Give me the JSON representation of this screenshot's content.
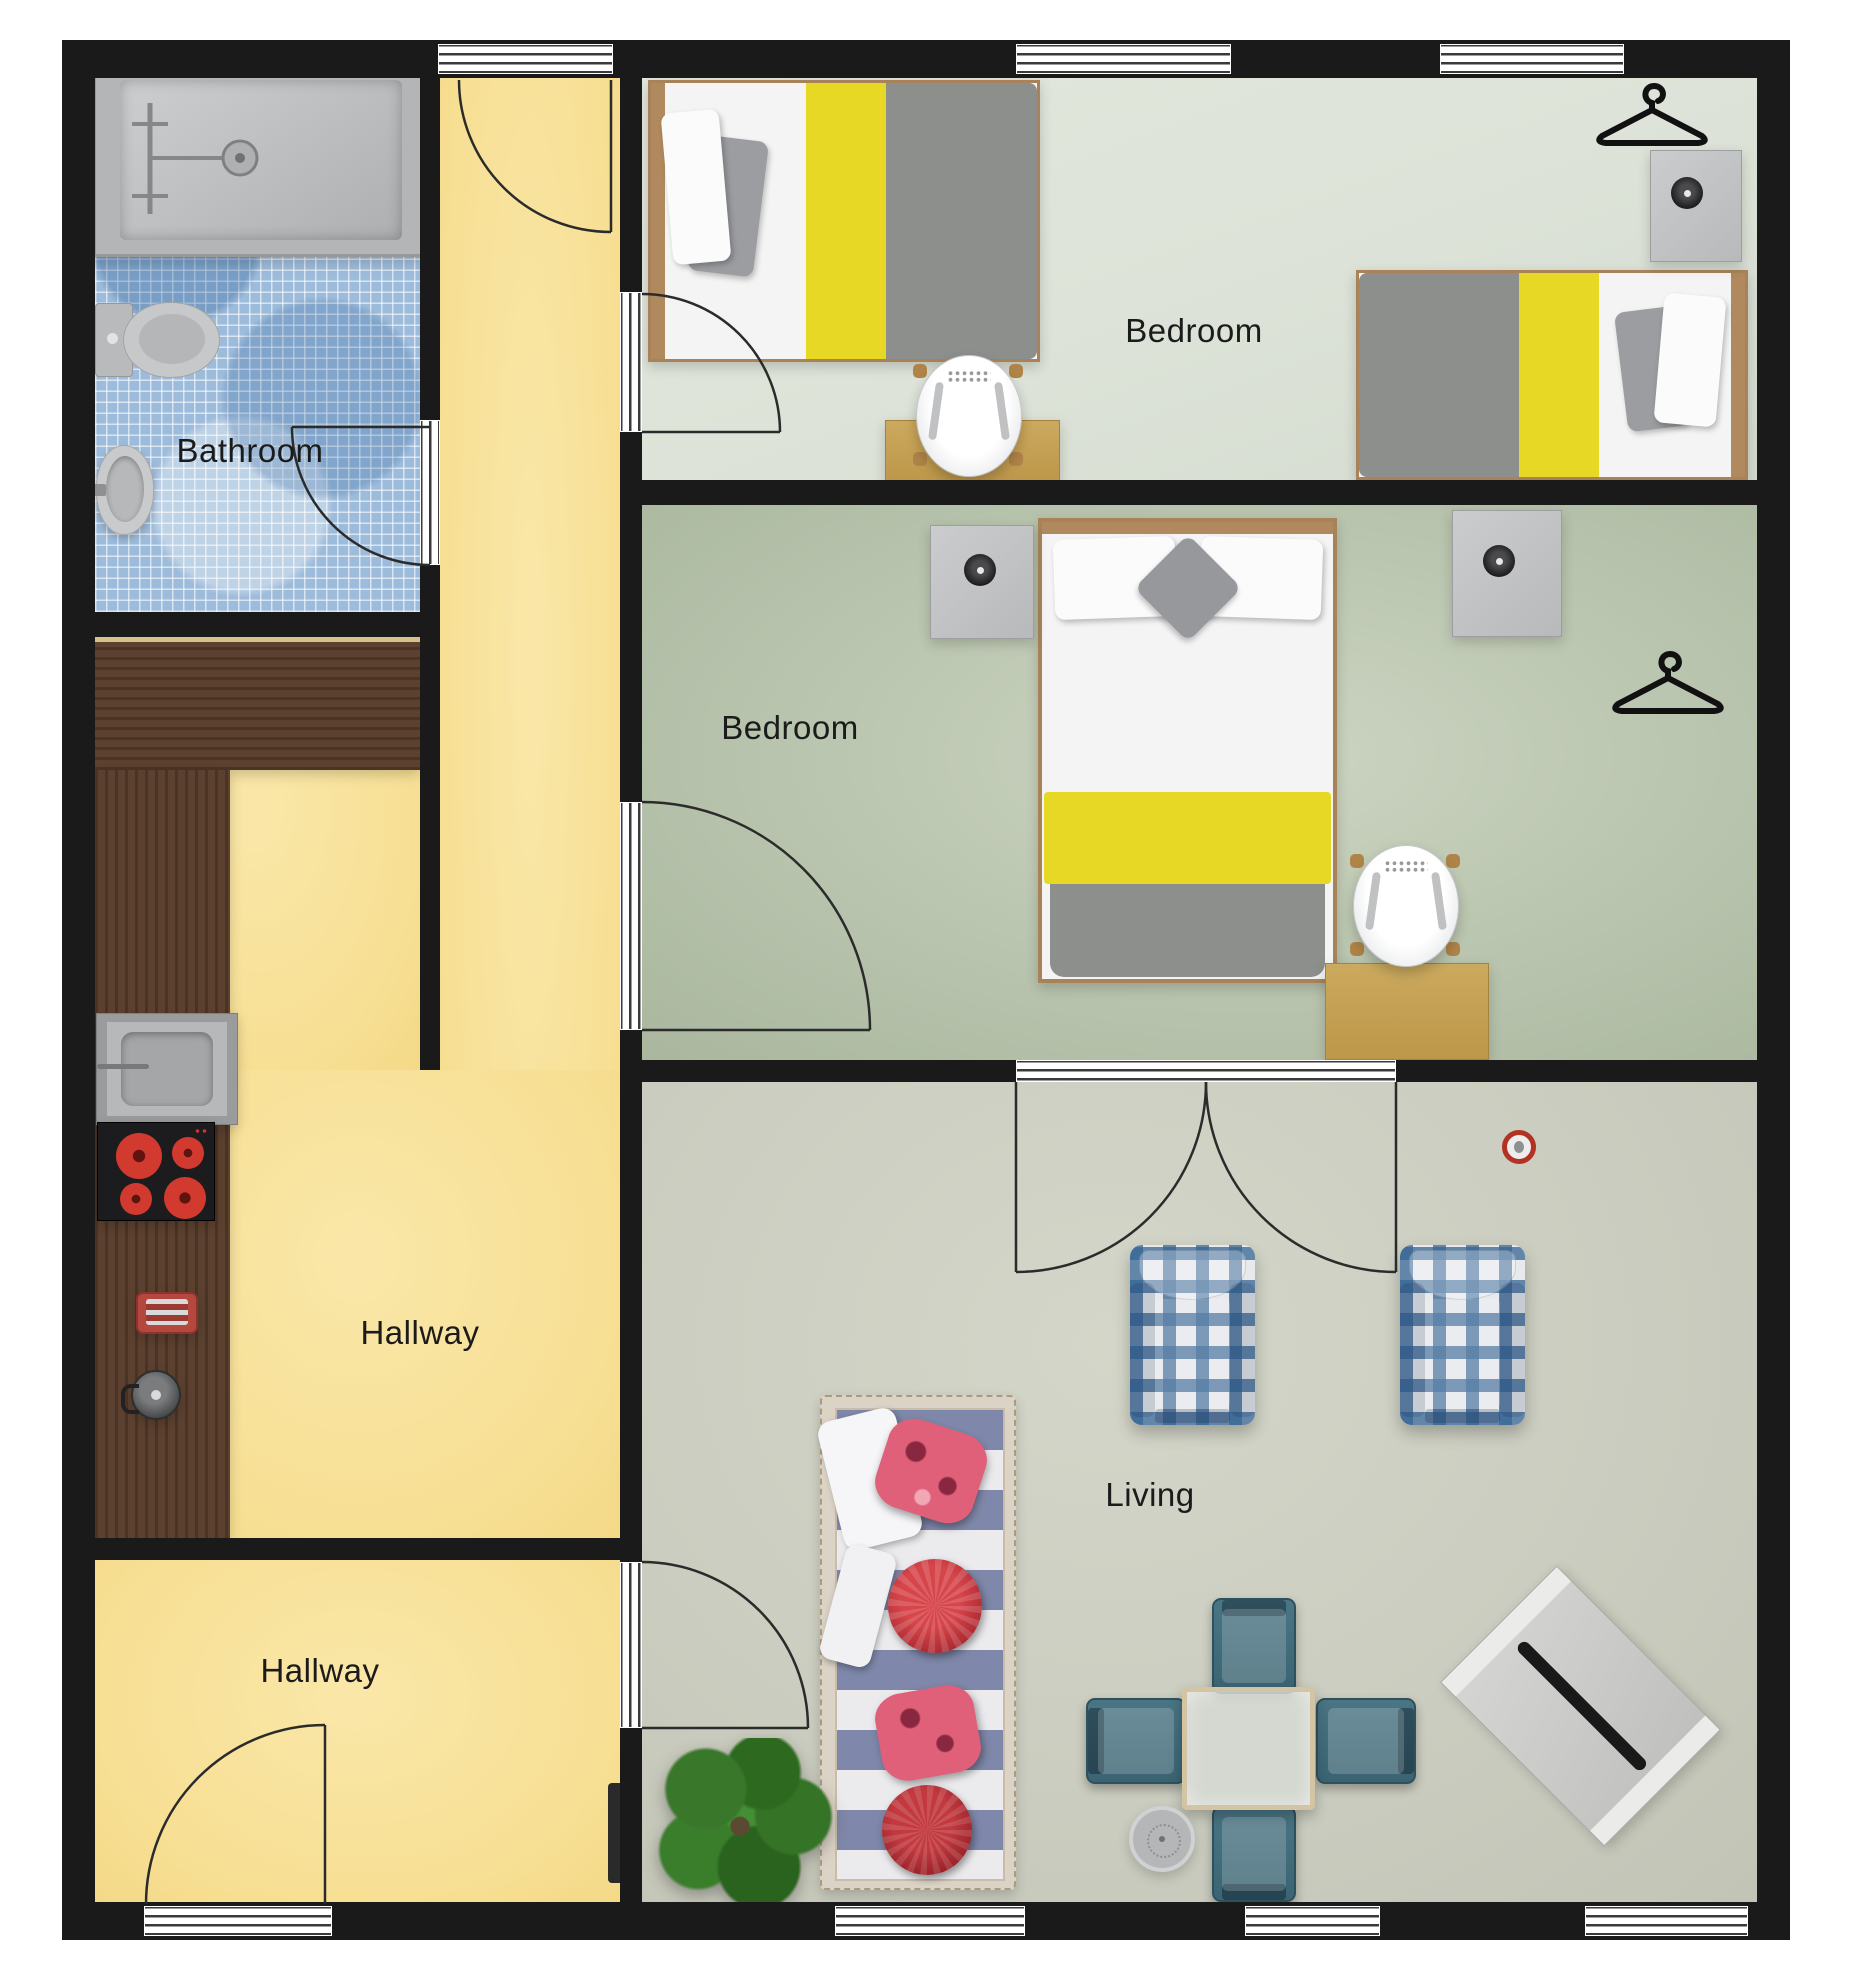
{
  "type": "floor-plan",
  "rooms": [
    {
      "id": "bathroom",
      "label": "Bathroom"
    },
    {
      "id": "bedroom-top",
      "label": "Bedroom"
    },
    {
      "id": "bedroom-middle",
      "label": "Bedroom"
    },
    {
      "id": "hallway-corridor",
      "label": "Hallway"
    },
    {
      "id": "hallway-entrance",
      "label": "Hallway"
    },
    {
      "id": "living",
      "label": "Living"
    }
  ],
  "palette": {
    "wall": "#1a1a1a",
    "floor_hallway_yellow": "#f7df94",
    "floor_bathroom_tile_blue": "#9dbbda",
    "floor_bedroom_top": "#dde3d8",
    "floor_bedroom_middle": "#b6c2ab",
    "floor_living": "#cbcdc0",
    "bed_accent_yellow": "#e8d826",
    "blanket_gray": "#8d8f8d",
    "counter_wood_dark": "#52382a",
    "desk_wood_tan": "#c6a054",
    "sofa_red_pillow": "#b3202a",
    "sofa_pink_pillow": "#e06377",
    "armchair_plaid_blue": "#366594",
    "dining_chair_teal": "#3b6472",
    "plant_green": "#39782b",
    "cooktop_burner_red": "#d33a2f",
    "detector_ring_red": "#b23324"
  },
  "furniture": [
    {
      "name": "bathtub",
      "room": "bathroom"
    },
    {
      "name": "shower-fixture",
      "room": "bathroom"
    },
    {
      "name": "toilet",
      "room": "bathroom"
    },
    {
      "name": "wash-basin",
      "room": "bathroom"
    },
    {
      "name": "l-shaped-kitchen-counter",
      "room": "hallway-corridor"
    },
    {
      "name": "kitchen-sink",
      "room": "hallway-corridor"
    },
    {
      "name": "cooktop-4-burner",
      "room": "hallway-corridor"
    },
    {
      "name": "toaster",
      "room": "hallway-corridor"
    },
    {
      "name": "kettle",
      "room": "hallway-corridor"
    },
    {
      "name": "single-bed-left",
      "room": "bedroom-top"
    },
    {
      "name": "single-bed-right",
      "room": "bedroom-top"
    },
    {
      "name": "desk",
      "room": "bedroom-top"
    },
    {
      "name": "desk-chair",
      "room": "bedroom-top"
    },
    {
      "name": "nightstand",
      "room": "bedroom-top"
    },
    {
      "name": "clothes-hanger",
      "room": "bedroom-top"
    },
    {
      "name": "double-bed",
      "room": "bedroom-middle"
    },
    {
      "name": "nightstand-left",
      "room": "bedroom-middle"
    },
    {
      "name": "nightstand-right",
      "room": "bedroom-middle"
    },
    {
      "name": "desk",
      "room": "bedroom-middle"
    },
    {
      "name": "desk-chair",
      "room": "bedroom-middle"
    },
    {
      "name": "clothes-hanger",
      "room": "bedroom-middle"
    },
    {
      "name": "striped-sofa-with-pillows",
      "room": "living"
    },
    {
      "name": "plaid-armchair-left",
      "room": "living"
    },
    {
      "name": "plaid-armchair-right",
      "room": "living"
    },
    {
      "name": "dining-table-glass",
      "room": "living"
    },
    {
      "name": "dining-chair",
      "room": "living",
      "count": 4
    },
    {
      "name": "diagonal-bench",
      "room": "living"
    },
    {
      "name": "round-side-table",
      "room": "living"
    },
    {
      "name": "potted-plant",
      "room": "living"
    },
    {
      "name": "smoke-detector",
      "room": "living"
    },
    {
      "name": "radiator",
      "room": "hallway-entrance"
    }
  ],
  "openings": {
    "windows_top_wall": 3,
    "windows_bottom_wall": 3,
    "entrance_door": 1,
    "interior_doors": 5,
    "glazed_double_door": 1
  }
}
